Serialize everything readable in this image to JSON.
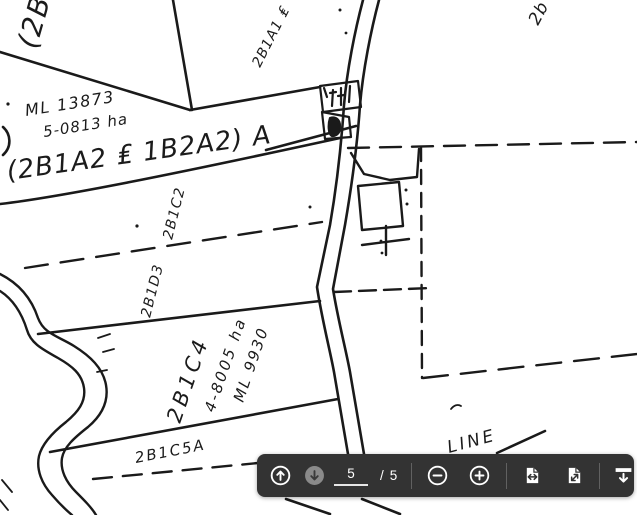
{
  "viewer": {
    "toolbar": {
      "page_current": "5",
      "page_separator": "/",
      "page_total": "5",
      "buttons": {
        "previous_page_icon": "arrow-up-circle",
        "next_page_icon": "arrow-down-circle",
        "zoom_out_icon": "minus-circle",
        "zoom_in_icon": "plus-circle",
        "fit_width_icon": "page-with-horizontal-arrows",
        "fit_page_icon": "page-with-diagonal-arrow",
        "download_icon": "bar-with-down-arrow"
      },
      "colors": {
        "background": "#333333",
        "icon": "#ffffff",
        "disabled_circle": "#8a8a8a",
        "disabled_arrow": "#3a3a3a",
        "divider": "#616161"
      }
    }
  },
  "map": {
    "ink_color": "#1a1a1a",
    "paper_color": "#ffffff",
    "labels": [
      {
        "id": "parcel-2b-partial",
        "text": "(2B"
      },
      {
        "id": "parcel-2b1a1",
        "text": "2B1A1 ₤"
      },
      {
        "id": "parcel-2b-top-right",
        "text": "2b"
      },
      {
        "id": "ml-13873",
        "text": "ML 13873"
      },
      {
        "id": "area-5-0813",
        "text": "5-0813 ha"
      },
      {
        "id": "road-strip",
        "text": "(2B1A2 ₤ 1B2A2) A"
      },
      {
        "id": "parcel-2b1c2",
        "text": "2B1C2"
      },
      {
        "id": "parcel-2b1d3",
        "text": "2B1D3"
      },
      {
        "id": "parcel-2b1c4",
        "text": "2B1C4"
      },
      {
        "id": "area-4-8005",
        "text": "4-8005 ha"
      },
      {
        "id": "ml-9930",
        "text": "ML 9930"
      },
      {
        "id": "parcel-2b1c5a",
        "text": "2B1C5A"
      },
      {
        "id": "line-label",
        "text": "LINE"
      }
    ]
  }
}
